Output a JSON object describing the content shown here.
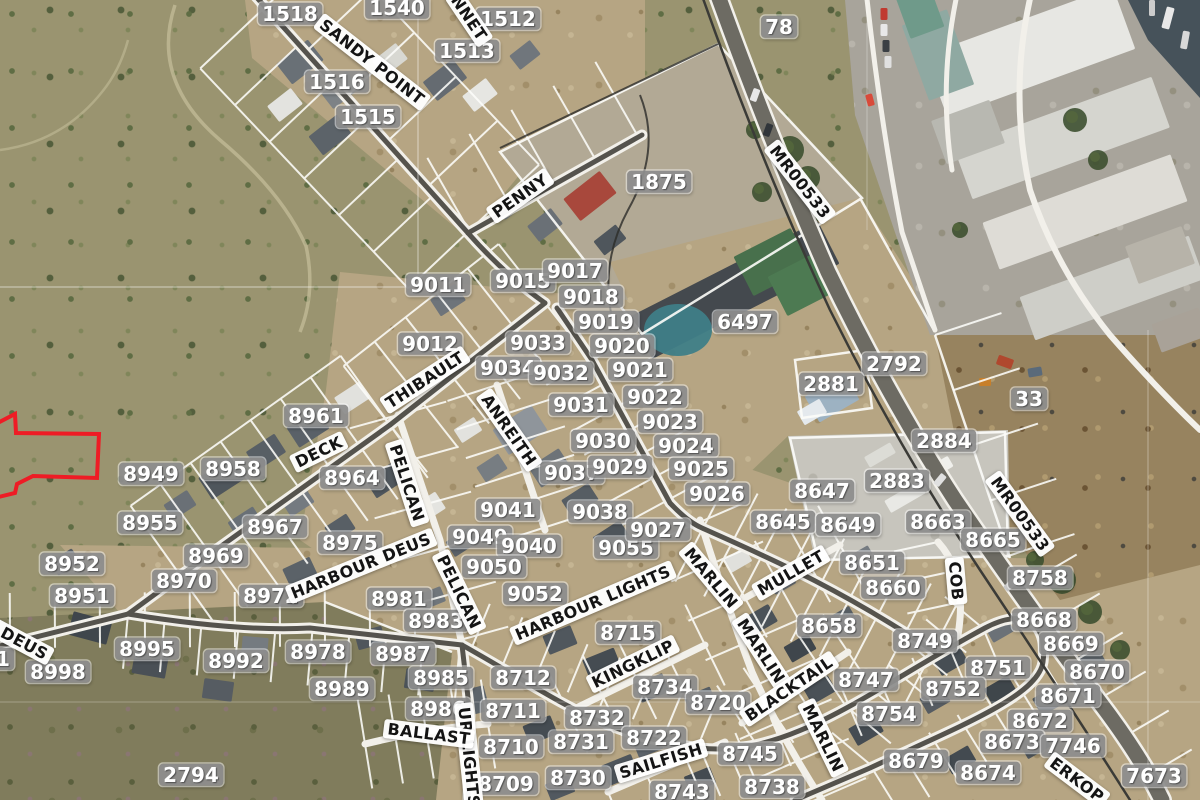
{
  "map": {
    "type": "aerial-cadastral-map",
    "colors": {
      "parcel_label_bg": "#8d8d8d",
      "parcel_label_text": "#ffffff",
      "street_label_bg": "#ffffff",
      "street_label_text": "#141414",
      "parcel_line": "#ffffff",
      "highlight_outline": "#ee1c25"
    },
    "highlight": {
      "description": "red outlined parcel at left edge",
      "color": "#ee1c25"
    },
    "parcel_labels": [
      {
        "t": "1518",
        "x": 290,
        "y": 14
      },
      {
        "t": "1540",
        "x": 397,
        "y": 8
      },
      {
        "t": "1512",
        "x": 508,
        "y": 19
      },
      {
        "t": "1513",
        "x": 467,
        "y": 51
      },
      {
        "t": "1516",
        "x": 337,
        "y": 82
      },
      {
        "t": "1515",
        "x": 368,
        "y": 117
      },
      {
        "t": "78",
        "x": 779,
        "y": 27
      },
      {
        "t": "1875",
        "x": 659,
        "y": 182
      },
      {
        "t": "9011",
        "x": 438,
        "y": 285
      },
      {
        "t": "9015",
        "x": 523,
        "y": 281
      },
      {
        "t": "9017",
        "x": 575,
        "y": 271
      },
      {
        "t": "9018",
        "x": 591,
        "y": 297
      },
      {
        "t": "9019",
        "x": 606,
        "y": 322
      },
      {
        "t": "9012",
        "x": 430,
        "y": 344
      },
      {
        "t": "9033",
        "x": 538,
        "y": 343
      },
      {
        "t": "9020",
        "x": 622,
        "y": 346
      },
      {
        "t": "6497",
        "x": 745,
        "y": 322
      },
      {
        "t": "9034",
        "x": 508,
        "y": 368
      },
      {
        "t": "9032",
        "x": 561,
        "y": 373
      },
      {
        "t": "9021",
        "x": 640,
        "y": 370
      },
      {
        "t": "2792",
        "x": 894,
        "y": 364
      },
      {
        "t": "2881",
        "x": 831,
        "y": 384
      },
      {
        "t": "9031",
        "x": 581,
        "y": 405
      },
      {
        "t": "9022",
        "x": 655,
        "y": 397
      },
      {
        "t": "9023",
        "x": 670,
        "y": 422
      },
      {
        "t": "33",
        "x": 1029,
        "y": 399
      },
      {
        "t": "9030",
        "x": 603,
        "y": 441
      },
      {
        "t": "9024",
        "x": 686,
        "y": 446
      },
      {
        "t": "2884",
        "x": 944,
        "y": 441
      },
      {
        "t": "8961",
        "x": 316,
        "y": 416
      },
      {
        "t": "9037",
        "x": 572,
        "y": 473
      },
      {
        "t": "9029",
        "x": 620,
        "y": 467
      },
      {
        "t": "9025",
        "x": 701,
        "y": 469
      },
      {
        "t": "8949",
        "x": 151,
        "y": 474
      },
      {
        "t": "8958",
        "x": 233,
        "y": 469
      },
      {
        "t": "8964",
        "x": 352,
        "y": 478
      },
      {
        "t": "9026",
        "x": 717,
        "y": 494
      },
      {
        "t": "8647",
        "x": 822,
        "y": 491
      },
      {
        "t": "2883",
        "x": 897,
        "y": 481
      },
      {
        "t": "8955",
        "x": 150,
        "y": 523
      },
      {
        "t": "8967",
        "x": 275,
        "y": 527
      },
      {
        "t": "9041",
        "x": 508,
        "y": 510
      },
      {
        "t": "9038",
        "x": 600,
        "y": 512
      },
      {
        "t": "8645",
        "x": 783,
        "y": 522
      },
      {
        "t": "8649",
        "x": 848,
        "y": 525
      },
      {
        "t": "8663",
        "x": 938,
        "y": 522
      },
      {
        "t": "8665",
        "x": 993,
        "y": 540
      },
      {
        "t": "8975",
        "x": 350,
        "y": 543
      },
      {
        "t": "9049",
        "x": 480,
        "y": 537
      },
      {
        "t": "9040",
        "x": 529,
        "y": 546
      },
      {
        "t": "9055",
        "x": 626,
        "y": 548
      },
      {
        "t": "9027",
        "x": 658,
        "y": 530
      },
      {
        "t": "8651",
        "x": 872,
        "y": 563
      },
      {
        "t": "8758",
        "x": 1040,
        "y": 578
      },
      {
        "t": "8952",
        "x": 72,
        "y": 564
      },
      {
        "t": "8969",
        "x": 216,
        "y": 556
      },
      {
        "t": "8970",
        "x": 184,
        "y": 581
      },
      {
        "t": "8951",
        "x": 82,
        "y": 596
      },
      {
        "t": "8972",
        "x": 271,
        "y": 596
      },
      {
        "t": "9050",
        "x": 494,
        "y": 567
      },
      {
        "t": "8660",
        "x": 893,
        "y": 588
      },
      {
        "t": "8981",
        "x": 399,
        "y": 599
      },
      {
        "t": "9052",
        "x": 535,
        "y": 594
      },
      {
        "t": "8668",
        "x": 1044,
        "y": 620
      },
      {
        "t": "8983",
        "x": 436,
        "y": 621
      },
      {
        "t": "8658",
        "x": 829,
        "y": 626
      },
      {
        "t": "8669",
        "x": 1071,
        "y": 644
      },
      {
        "t": "8995",
        "x": 147,
        "y": 649
      },
      {
        "t": "8992",
        "x": 236,
        "y": 661
      },
      {
        "t": "8978",
        "x": 318,
        "y": 652
      },
      {
        "t": "8987",
        "x": 403,
        "y": 654
      },
      {
        "t": "8715",
        "x": 628,
        "y": 633
      },
      {
        "t": "8712",
        "x": 523,
        "y": 678
      },
      {
        "t": "8670",
        "x": 1097,
        "y": 672
      },
      {
        "t": "8998",
        "x": 58,
        "y": 672
      },
      {
        "t": "8749",
        "x": 925,
        "y": 641
      },
      {
        "t": "8751",
        "x": 998,
        "y": 668
      },
      {
        "t": "8671",
        "x": 1068,
        "y": 696
      },
      {
        "t": "8985",
        "x": 441,
        "y": 678
      },
      {
        "t": "8734",
        "x": 665,
        "y": 687
      },
      {
        "t": "8747",
        "x": 866,
        "y": 680
      },
      {
        "t": "8752",
        "x": 953,
        "y": 689
      },
      {
        "t": "8989",
        "x": 342,
        "y": 689
      },
      {
        "t": "8720",
        "x": 718,
        "y": 703
      },
      {
        "t": "8672",
        "x": 1040,
        "y": 721
      },
      {
        "t": "8986",
        "x": 438,
        "y": 709
      },
      {
        "t": "8711",
        "x": 513,
        "y": 711
      },
      {
        "t": "8732",
        "x": 597,
        "y": 718
      },
      {
        "t": "8754",
        "x": 889,
        "y": 714
      },
      {
        "t": "8673",
        "x": 1012,
        "y": 742
      },
      {
        "t": "7746",
        "x": 1073,
        "y": 746
      },
      {
        "t": "8731",
        "x": 581,
        "y": 742
      },
      {
        "t": "8722",
        "x": 654,
        "y": 738
      },
      {
        "t": "8745",
        "x": 750,
        "y": 754
      },
      {
        "t": "8710",
        "x": 511,
        "y": 747
      },
      {
        "t": "8730",
        "x": 578,
        "y": 778
      },
      {
        "t": "8679",
        "x": 916,
        "y": 761
      },
      {
        "t": "8674",
        "x": 988,
        "y": 773
      },
      {
        "t": "7673",
        "x": 1154,
        "y": 776
      },
      {
        "t": "8738",
        "x": 772,
        "y": 787
      },
      {
        "t": "8743",
        "x": 682,
        "y": 792
      },
      {
        "t": "8709",
        "x": 506,
        "y": 784
      },
      {
        "t": "2794",
        "x": 191,
        "y": 775
      },
      {
        "t": "1",
        "x": 3,
        "y": 659
      }
    ],
    "street_labels": [
      {
        "t": "SANDY POINT",
        "x": 372,
        "y": 62,
        "r": 38
      },
      {
        "t": "NNET",
        "x": 469,
        "y": 18,
        "r": 56
      },
      {
        "t": "PENNY",
        "x": 520,
        "y": 196,
        "r": -35
      },
      {
        "t": "MR00533",
        "x": 800,
        "y": 182,
        "r": 52
      },
      {
        "t": "THIBAULT",
        "x": 425,
        "y": 380,
        "r": -33
      },
      {
        "t": "ANREITH",
        "x": 509,
        "y": 430,
        "r": 55
      },
      {
        "t": "DECK",
        "x": 319,
        "y": 452,
        "r": -26
      },
      {
        "t": "PELICAN",
        "x": 407,
        "y": 483,
        "r": 72
      },
      {
        "t": "HARBOUR DEUS",
        "x": 361,
        "y": 566,
        "r": -22
      },
      {
        "t": "PELICAN",
        "x": 459,
        "y": 592,
        "r": 64
      },
      {
        "t": "R DEUS",
        "x": 16,
        "y": 639,
        "r": 28
      },
      {
        "t": "HARBOUR LIGHTS",
        "x": 593,
        "y": 603,
        "r": -23
      },
      {
        "t": "UR LIGHTS",
        "x": 469,
        "y": 757,
        "r": 84
      },
      {
        "t": "BALLAST",
        "x": 429,
        "y": 734,
        "r": 7
      },
      {
        "t": "KINGKLIP",
        "x": 633,
        "y": 664,
        "r": -26
      },
      {
        "t": "MARLIN",
        "x": 711,
        "y": 578,
        "r": 50
      },
      {
        "t": "MULLET",
        "x": 791,
        "y": 573,
        "r": -30
      },
      {
        "t": "MARLIN",
        "x": 761,
        "y": 651,
        "r": 57
      },
      {
        "t": "BLACKTAIL",
        "x": 789,
        "y": 689,
        "r": -34
      },
      {
        "t": "SAILFISH",
        "x": 661,
        "y": 761,
        "r": -17
      },
      {
        "t": "MARLIN",
        "x": 823,
        "y": 738,
        "r": 64
      },
      {
        "t": "COB",
        "x": 956,
        "y": 581,
        "r": 85
      },
      {
        "t": "MR00533",
        "x": 1020,
        "y": 514,
        "r": 54
      },
      {
        "t": "ERKOP",
        "x": 1077,
        "y": 780,
        "r": 37
      }
    ]
  }
}
